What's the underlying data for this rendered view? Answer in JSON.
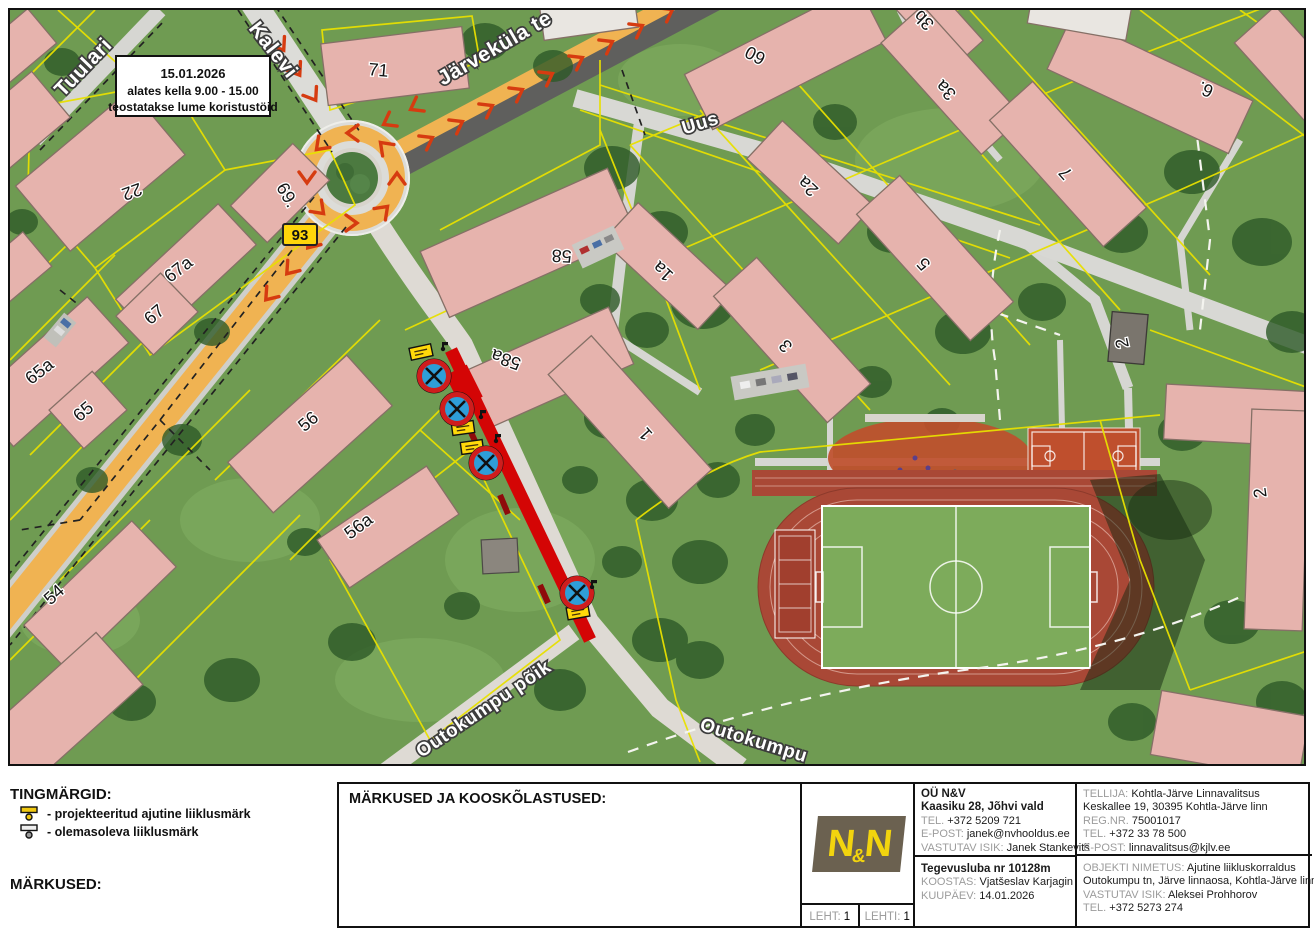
{
  "notice_box": {
    "line1": "15.01.2026",
    "line2": "alates kella 9.00 - 15.00",
    "line3": "teostatakse lume koristustöid"
  },
  "map": {
    "road_number": "93",
    "streets": [
      "Tuulari",
      "Kalevi",
      "Järveküla te",
      "Uus",
      "Outokumpu põik",
      "Outokumpu"
    ],
    "building_labels": [
      "71",
      "22",
      "69.",
      "67a",
      "67",
      "65a",
      "65",
      "58",
      "58a",
      "56",
      "56a",
      "54",
      "60",
      "3b",
      "3a",
      "2a",
      "1a",
      "1",
      "3",
      "5",
      "7",
      "6.",
      "2",
      "2"
    ]
  },
  "legend": {
    "title": "TINGMÄRGID:",
    "items": [
      {
        "icon": "planned-temporary-sign-icon",
        "label": "- projekteeritud ajutine liiklusmärk"
      },
      {
        "icon": "existing-sign-icon",
        "label": "- olemasoleva liiklusmärk"
      }
    ],
    "notes_title": "MÄRKUSED:"
  },
  "title_block": {
    "notes_header": "MÄRKUSED JA KOOSKÕLASTUSED:",
    "logo_text": {
      "n1": "N",
      "amp": "&",
      "n2": "N"
    },
    "company": {
      "name": "OÜ N&V",
      "address": "Kaasiku 28, Jõhvi vald",
      "tel_label": "TEL.",
      "tel": "+372 5209 721",
      "email_label": "E-POST:",
      "email": "janek@nvhooldus.ee",
      "responsible_label": "VASTUTAV ISIK:",
      "responsible": "Janek Stankevitš",
      "license": "Tegevusluba nr 10128m",
      "koostas_label": "KOOSTAS:",
      "koostas": "Vjatšeslav Karjagin",
      "kuupaev_label": "KUUPÄEV:",
      "kuupaev": "14.01.2026"
    },
    "client": {
      "tellija_label": "TELLIJA:",
      "tellija": "Kohtla-Järve Linnavalitsus",
      "address": "Keskallee 19, 30395 Kohtla-Järve linn",
      "regnr_label": "REG.NR.",
      "regnr": "75001017",
      "tel_label": "TEL.",
      "tel": "+372 33 78 500",
      "email_label": "E-POST:",
      "email": "linnavalitsus@kjlv.ee",
      "object_label": "OBJEKTI NIMETUS:",
      "object_line1": "Ajutine liikluskorraldus",
      "object_line2": "Outokumpu tn, Järve linnaosa, Kohtla-Järve linn",
      "responsible_label": "VASTUTAV ISIK:",
      "responsible": "Aleksei Prohhorov",
      "tel2_label": "TEL.",
      "tel2": "+372 5273 274"
    },
    "sheet": {
      "leht_label": "LEHT:",
      "leht": "1",
      "lehti_label": "LEHTI:",
      "lehti": "1"
    }
  }
}
